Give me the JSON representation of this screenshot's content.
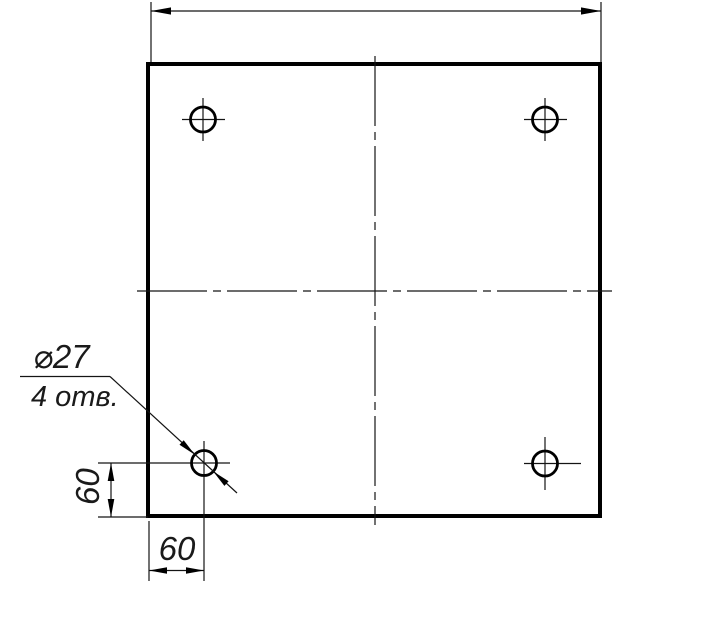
{
  "canvas": {
    "background_color": "#ffffff",
    "line_color": "#000000"
  },
  "drawing": {
    "type": "technical-drawing",
    "view": "square plate, front view, 4 drilled holes",
    "callout": {
      "line1": "⌀27",
      "line2": "4 отв."
    },
    "dimensions": {
      "vertical_offset": "60",
      "horizontal_offset": "60"
    }
  }
}
